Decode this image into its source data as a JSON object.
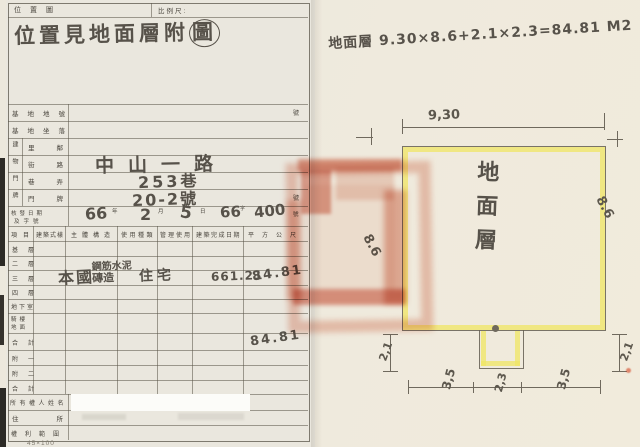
{
  "header": {
    "map_label": "位置圖",
    "scale_label": "比例尺:",
    "handwritten_title": "位置見地面層附",
    "handwritten_title_last": "圖",
    "handwritten_note": "地面層 9.30×8.6+2.1×2.3=84.81 M2"
  },
  "form": {
    "site_rows": [
      {
        "label": "基地地號",
        "unit": "號",
        "value": ""
      },
      {
        "label": "基地坐落",
        "unit": "",
        "value": ""
      }
    ],
    "address_group_label": "建物門牌",
    "address_rows": [
      {
        "label": "里鄰",
        "value": ""
      },
      {
        "label": "街路",
        "value": "中山一路"
      },
      {
        "label": "巷弄",
        "value": "253巷"
      },
      {
        "label": "門牌",
        "value": "20-2號",
        "unit": "號"
      }
    ],
    "issue": {
      "label_line1": "核發日期",
      "label_line2": "及字號",
      "year": "66",
      "year_unit": "年",
      "month": "2",
      "month_unit": "月",
      "day": "5",
      "day_unit": "日",
      "ref": "66",
      "ref_unit": "字",
      "number": "400",
      "number_unit": "號"
    },
    "table": {
      "headers": [
        "項目",
        "建築式樣",
        "主體構造",
        "使用種類",
        "管理使用",
        "建築完成日期",
        "平方公尺"
      ],
      "floors": [
        "基層",
        "二層",
        "三層",
        "四層",
        "地下室",
        "騎樓地面",
        "合計",
        "附一",
        "附二",
        "合計"
      ],
      "entry": {
        "style": "本國",
        "structure_line1": "鋼筋水泥",
        "structure_line2": "磚造",
        "use": "住宅",
        "completion_date": "661.21",
        "area": "84.81"
      },
      "total_area": "84.81"
    },
    "owner_labels": [
      "所有權人姓名",
      "住所",
      "權利範圍"
    ],
    "footer_note": "45×100"
  },
  "plan": {
    "room_label": "地面層",
    "dims": {
      "top": "9,30",
      "left": "8.6",
      "right": "8.6",
      "side_left": "2,1",
      "side_right": "2,1",
      "bottom_left": "3,5",
      "bottom_mid": "2,3",
      "bottom_right": "3,5"
    }
  },
  "colors": {
    "paper_left": "#eae7de",
    "paper_right": "#f3edde",
    "grid_line": "#5a5549",
    "pencil": "#5c574d",
    "highlight_yellow": "#f1e765",
    "stamp_red": "#d05a32"
  }
}
